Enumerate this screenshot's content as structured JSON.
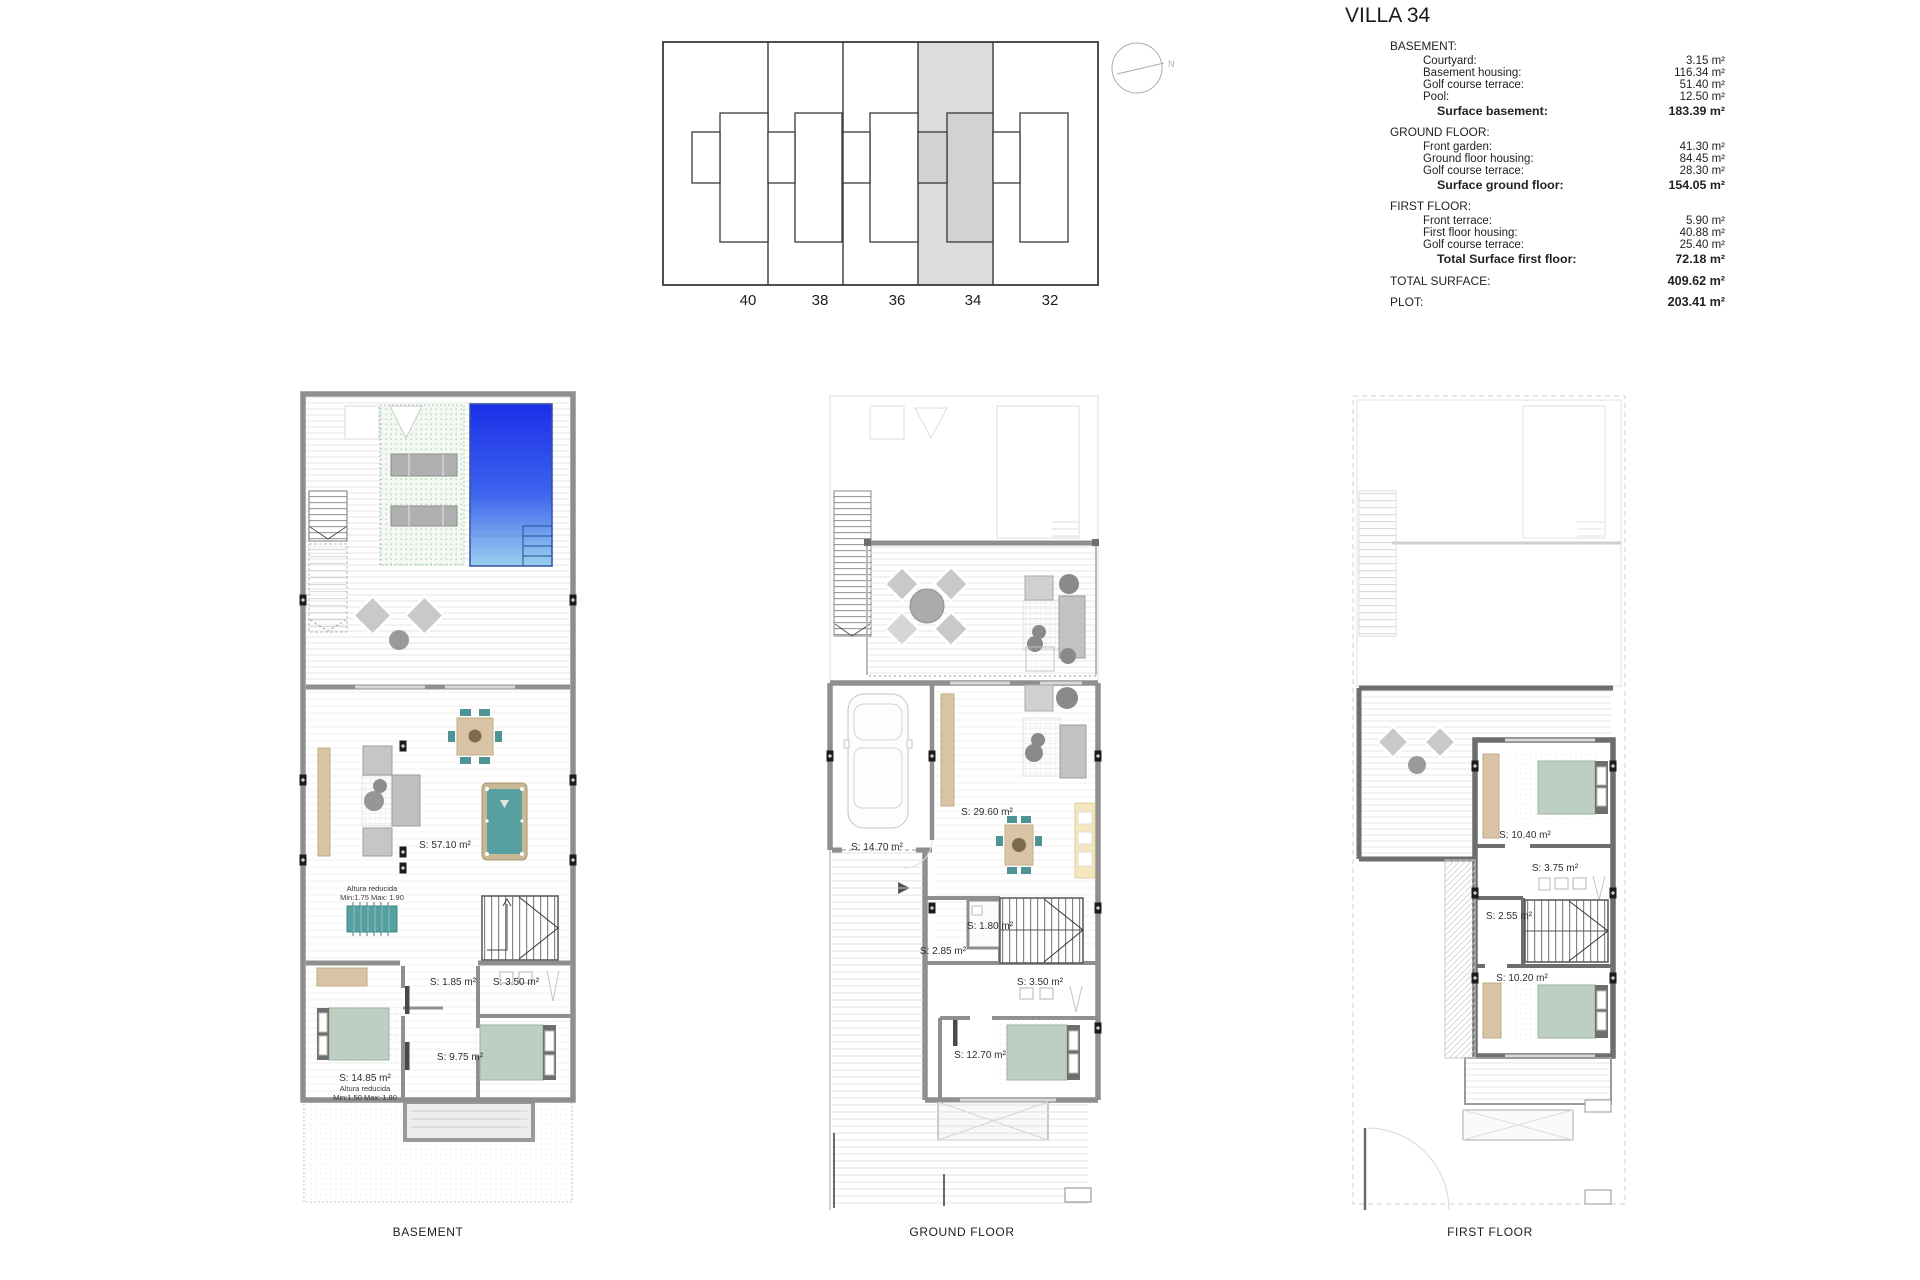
{
  "title": "VILLA 34",
  "site_plan": {
    "plots": [
      "40",
      "38",
      "36",
      "34",
      "32"
    ],
    "highlighted_plot": "34",
    "compass_label": "N"
  },
  "surface_table": {
    "sections": [
      {
        "header": "BASEMENT:",
        "rows": [
          {
            "label": "Courtyard:",
            "value": "3.15 m²"
          },
          {
            "label": "Basement housing:",
            "value": "116.34 m²"
          },
          {
            "label": "Golf course terrace:",
            "value": "51.40 m²"
          },
          {
            "label": "Pool:",
            "value": "12.50 m²"
          }
        ],
        "total": {
          "label": "Surface basement:",
          "value": "183.39 m²"
        }
      },
      {
        "header": "GROUND FLOOR:",
        "rows": [
          {
            "label": "Front garden:",
            "value": "41.30 m²"
          },
          {
            "label": "Ground floor housing:",
            "value": "84.45 m²"
          },
          {
            "label": "Golf course terrace:",
            "value": "28.30 m²"
          }
        ],
        "total": {
          "label": "Surface ground floor:",
          "value": "154.05 m²"
        }
      },
      {
        "header": "FIRST FLOOR:",
        "rows": [
          {
            "label": "Front terrace:",
            "value": "5.90 m²"
          },
          {
            "label": "First floor housing:",
            "value": "40.88 m²"
          },
          {
            "label": "Golf course terrace:",
            "value": "25.40 m²"
          }
        ],
        "total": {
          "label": "Total Surface first floor:",
          "value": "72.18 m²"
        }
      }
    ],
    "summary": [
      {
        "label": "TOTAL SURFACE:",
        "value": "409.62 m²"
      },
      {
        "label": "PLOT:",
        "value": "203.41 m²"
      }
    ]
  },
  "plans": {
    "basement": {
      "label": "BASEMENT",
      "areas": {
        "living": "S: 57.10 m²",
        "storage": "S: 1.85 m²",
        "bathroom": "S: 3.50 m²",
        "corridor": "S: 9.75 m²",
        "bedroom": "S: 14.85 m²"
      },
      "notes": {
        "living_note1": "Altura reducida",
        "living_note2": "Min:1.75 Max: 1.90",
        "bedroom_note1": "Altura reducida",
        "bedroom_note2": "Min:1.50 Max: 1.80"
      }
    },
    "ground": {
      "label": "GROUND FLOOR",
      "areas": {
        "garage": "S: 14.70 m²",
        "living_kitchen": "S: 29.60 m²",
        "wc": "S: 1.80 m²",
        "hall": "S: 2.85 m²",
        "bathroom": "S: 3.50 m²",
        "bedroom": "S: 12.70 m²"
      }
    },
    "first": {
      "label": "FIRST FLOOR",
      "areas": {
        "bedroom_1": "S: 10.40 m²",
        "bathroom": "S: 3.75 m²",
        "hall": "S: 2.55 m²",
        "bedroom_2": "S: 10.20 m²"
      }
    }
  },
  "colors": {
    "pool_top": "#1b2fe8",
    "pool_bottom": "#9bd1ef",
    "bed_green": "#bccfc2",
    "chair_teal": "#4e9494",
    "wood_tan": "#d9c5a5",
    "kitchen_yellow": "#f5e7bd",
    "plot_highlight": "#dcdcdc"
  }
}
